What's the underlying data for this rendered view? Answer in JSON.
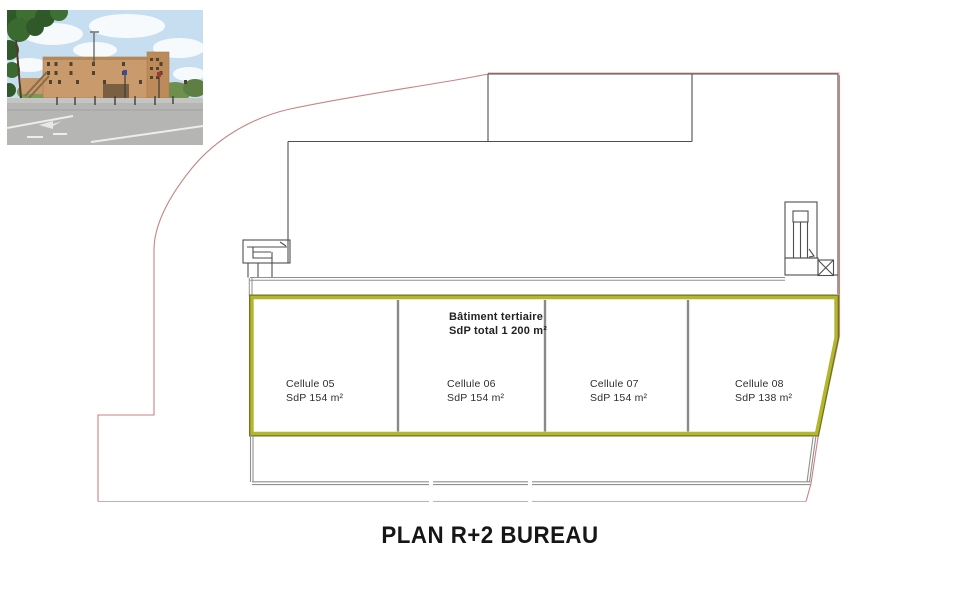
{
  "page": {
    "title": "PLAN R+2 BUREAU"
  },
  "plan": {
    "building_note": {
      "line1": "Bâtiment tertiaire",
      "line2": "SdP total 1 200 m²"
    },
    "cells": [
      {
        "name": "Cellule 05",
        "area": "SdP 154 m²"
      },
      {
        "name": "Cellule 06",
        "area": "SdP 154 m²"
      },
      {
        "name": "Cellule 07",
        "area": "SdP 154 m²"
      },
      {
        "name": "Cellule 08",
        "area": "SdP 138 m²"
      }
    ],
    "colors": {
      "cells_outline": "#b3b62e",
      "cells_outline_dark": "#71751a",
      "boundary": "#c98383",
      "drawing_line": "#4f4f4f",
      "divider": "#8a8a8a"
    }
  }
}
